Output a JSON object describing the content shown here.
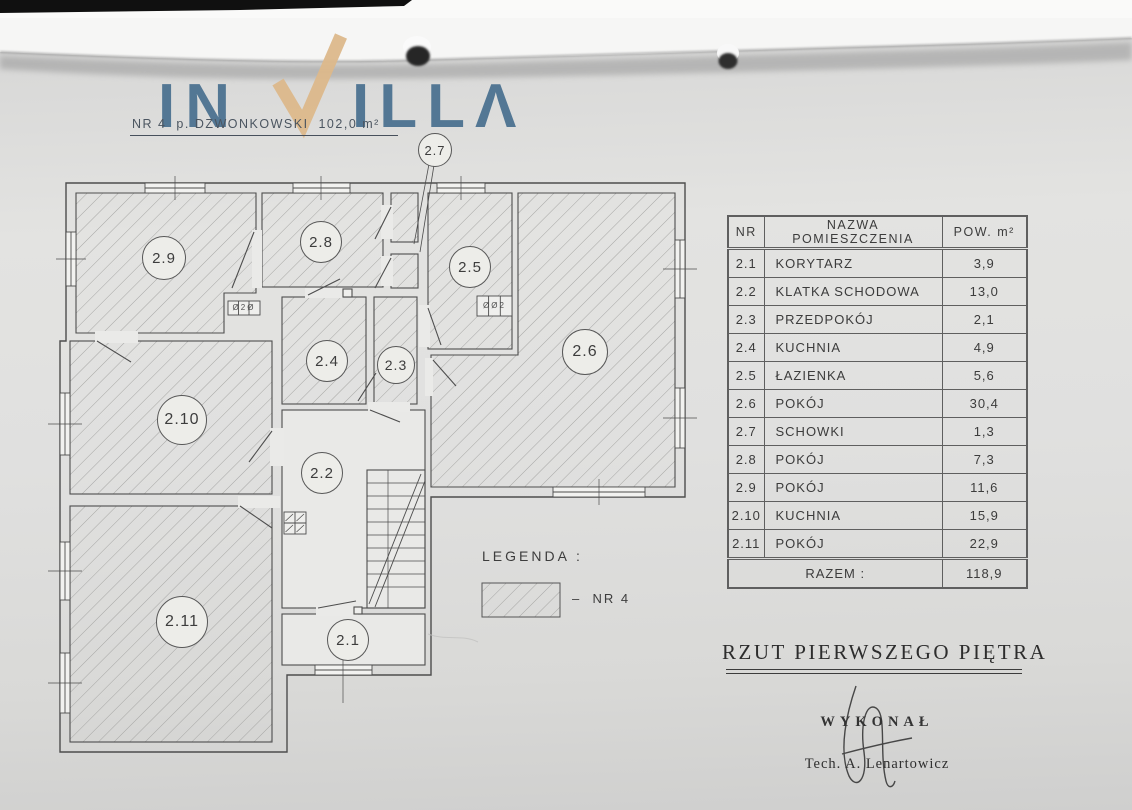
{
  "brand": {
    "name": "INVILLA",
    "part1": "IN",
    "v": "V",
    "part2": "ILLΛ"
  },
  "header_note": "NR 4  p. DZWONKOWSKI  102,0 m²",
  "plan": {
    "rooms": [
      {
        "label": "2.1"
      },
      {
        "label": "2.2"
      },
      {
        "label": "2.3"
      },
      {
        "label": "2.4"
      },
      {
        "label": "2.5"
      },
      {
        "label": "2.6"
      },
      {
        "label": "2.7"
      },
      {
        "label": "2.8"
      },
      {
        "label": "2.9"
      },
      {
        "label": "2.10"
      },
      {
        "label": "2.11"
      }
    ],
    "vents": {
      "left": "Ø2Ø",
      "right": "ØØ2"
    }
  },
  "legend": {
    "title": "LEGENDA :",
    "item": "–  NR 4"
  },
  "table": {
    "headers": [
      "NR",
      "NAZWA POMIESZCZENIA",
      "POW. m²"
    ],
    "rows": [
      [
        "2.1",
        "KORYTARZ",
        "3,9"
      ],
      [
        "2.2",
        "KLATKA SCHODOWA",
        "13,0"
      ],
      [
        "2.3",
        "PRZEDPOKÓJ",
        "2,1"
      ],
      [
        "2.4",
        "KUCHNIA",
        "4,9"
      ],
      [
        "2.5",
        "ŁAZIENKA",
        "5,6"
      ],
      [
        "2.6",
        "POKÓJ",
        "30,4"
      ],
      [
        "2.7",
        "SCHOWKI",
        "1,3"
      ],
      [
        "2.8",
        "POKÓJ",
        "7,3"
      ],
      [
        "2.9",
        "POKÓJ",
        "11,6"
      ],
      [
        "2.10",
        "KUCHNIA",
        "15,9"
      ],
      [
        "2.11",
        "POKÓJ",
        "22,9"
      ]
    ],
    "total_label": "RAZEM :",
    "total_value": "118,9"
  },
  "footer": {
    "title": "RZUT PIERWSZEGO PIĘTRA",
    "made_by": "WYKONAŁ",
    "author": "Tech. A. Lenartowicz"
  },
  "colors": {
    "logo_blue": "#49708f",
    "logo_tan": "#dcb88b"
  }
}
